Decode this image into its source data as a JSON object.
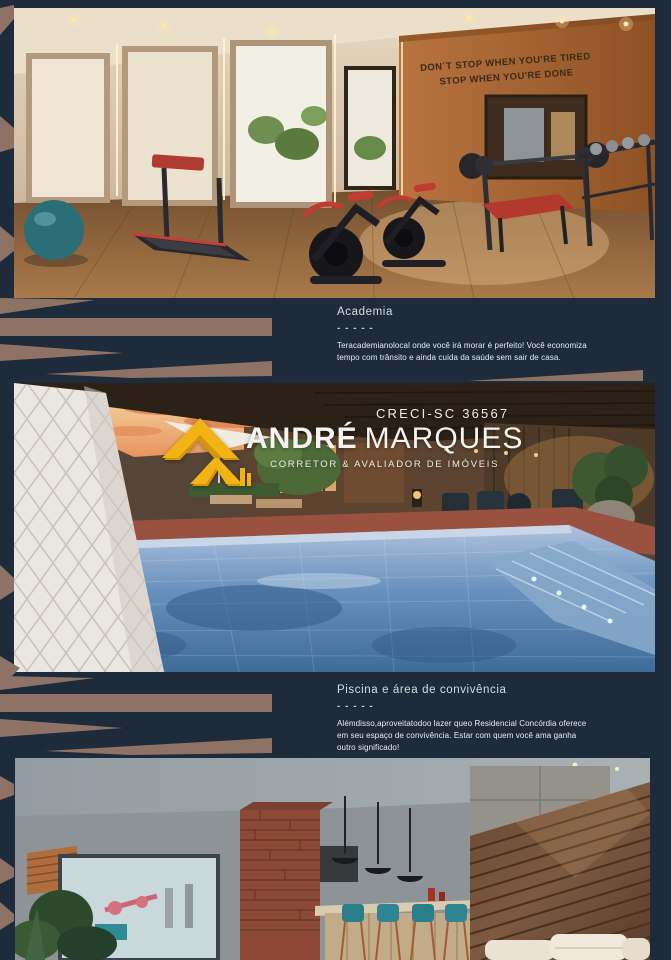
{
  "page": {
    "background_color": "#1E2B3A",
    "accent_tan_color": "#8F7266"
  },
  "brand": {
    "creci": "CRECI-SC 36567",
    "name_first": "ANDRÉ",
    "name_last": "MARQUES",
    "tagline": "CORRETOR & AVALIADOR DE IMÓVEIS",
    "logo_gold_color": "#F2B414"
  },
  "photos": {
    "gym": {
      "wall_quote_line1": "DON´T STOP WHEN YOU'RE TIRED",
      "wall_quote_line2": "STOP WHEN YOU'RE DONE"
    }
  },
  "sections": [
    {
      "title": "Academia",
      "dashes": "- - - - -",
      "body": "Teracademianolocal onde você irá morar é perfeito! Você economiza tempo com trânsito e ainda cuida da saúde sem sair de casa."
    },
    {
      "title": "Piscina e área de convivência",
      "dashes": "- - - - -",
      "body": "Alémdisso,aproveitatodoo lazer queo Residencial Concórdia oferece em seu espaço de convivência. Estar com quem você ama ganha outro significado!"
    }
  ]
}
